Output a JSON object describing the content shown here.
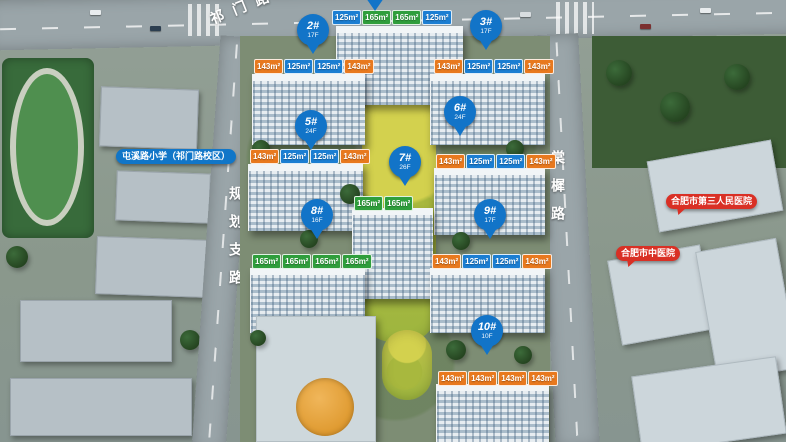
{
  "scene": {
    "description": "航拍楼盘规划效果图"
  },
  "roads": {
    "top_label": "祁门路",
    "left_label": "规划支路",
    "right_label": "棠樨路"
  },
  "landmarks": {
    "school": {
      "label": "屯溪路小学（祁门路校区）"
    },
    "hospital_1": {
      "label": "合肥市第三人民医院"
    },
    "hospital_2": {
      "label": "合肥市中医院"
    }
  },
  "buildings": [
    {
      "id": "2",
      "label": "2#",
      "floors": "17F",
      "pin": {
        "x": 297,
        "y": 14
      }
    },
    {
      "id": "3",
      "label": "3#",
      "floors": "17F",
      "pin": {
        "x": 470,
        "y": 10
      }
    },
    {
      "id": "5",
      "label": "5#",
      "floors": "24F",
      "pin": {
        "x": 295,
        "y": 110
      }
    },
    {
      "id": "6",
      "label": "6#",
      "floors": "24F",
      "pin": {
        "x": 444,
        "y": 96
      }
    },
    {
      "id": "7",
      "label": "7#",
      "floors": "26F",
      "pin": {
        "x": 389,
        "y": 146
      }
    },
    {
      "id": "8",
      "label": "8#",
      "floors": "16F",
      "pin": {
        "x": 301,
        "y": 199
      }
    },
    {
      "id": "9",
      "label": "9#",
      "floors": "17F",
      "pin": {
        "x": 474,
        "y": 199
      }
    },
    {
      "id": "10",
      "label": "10#",
      "floors": "10F",
      "pin": {
        "x": 471,
        "y": 315
      }
    }
  ],
  "unit_tag_rows": [
    {
      "x": 332,
      "y": 10,
      "tags": [
        {
          "text": "125m²",
          "color": "blue"
        },
        {
          "text": "165m²",
          "color": "green"
        },
        {
          "text": "165m²",
          "color": "green"
        },
        {
          "text": "125m²",
          "color": "blue"
        }
      ]
    },
    {
      "x": 254,
      "y": 59,
      "tags": [
        {
          "text": "143m²",
          "color": "orange"
        },
        {
          "text": "125m²",
          "color": "blue"
        },
        {
          "text": "125m²",
          "color": "blue"
        },
        {
          "text": "143m²",
          "color": "orange"
        }
      ]
    },
    {
      "x": 434,
      "y": 59,
      "tags": [
        {
          "text": "143m²",
          "color": "orange"
        },
        {
          "text": "125m²",
          "color": "blue"
        },
        {
          "text": "125m²",
          "color": "blue"
        },
        {
          "text": "143m²",
          "color": "orange"
        }
      ]
    },
    {
      "x": 250,
      "y": 149,
      "tags": [
        {
          "text": "143m²",
          "color": "orange"
        },
        {
          "text": "125m²",
          "color": "blue"
        },
        {
          "text": "125m²",
          "color": "blue"
        },
        {
          "text": "143m²",
          "color": "orange"
        }
      ]
    },
    {
      "x": 436,
      "y": 154,
      "tags": [
        {
          "text": "143m²",
          "color": "orange"
        },
        {
          "text": "125m²",
          "color": "blue"
        },
        {
          "text": "125m²",
          "color": "blue"
        },
        {
          "text": "143m²",
          "color": "orange"
        }
      ]
    },
    {
      "x": 354,
      "y": 196,
      "tags": [
        {
          "text": "165m²",
          "color": "green"
        },
        {
          "text": "165m²",
          "color": "green"
        }
      ]
    },
    {
      "x": 252,
      "y": 254,
      "tags": [
        {
          "text": "165m²",
          "color": "green"
        },
        {
          "text": "165m²",
          "color": "green"
        },
        {
          "text": "165m²",
          "color": "green"
        },
        {
          "text": "165m²",
          "color": "green"
        }
      ]
    },
    {
      "x": 432,
      "y": 254,
      "tags": [
        {
          "text": "143m²",
          "color": "orange"
        },
        {
          "text": "125m²",
          "color": "blue"
        },
        {
          "text": "125m²",
          "color": "blue"
        },
        {
          "text": "143m²",
          "color": "orange"
        }
      ]
    },
    {
      "x": 438,
      "y": 371,
      "tags": [
        {
          "text": "143m²",
          "color": "orange"
        },
        {
          "text": "143m²",
          "color": "orange"
        },
        {
          "text": "143m²",
          "color": "orange"
        },
        {
          "text": "143m²",
          "color": "orange"
        }
      ]
    }
  ],
  "colors": {
    "pin": "#1274c8",
    "tag_blue": "#1b7ed2",
    "tag_green": "#2f9e3c",
    "tag_orange": "#e8791e",
    "bubble_red": "#d93025",
    "school_blue": "#1176c8"
  }
}
